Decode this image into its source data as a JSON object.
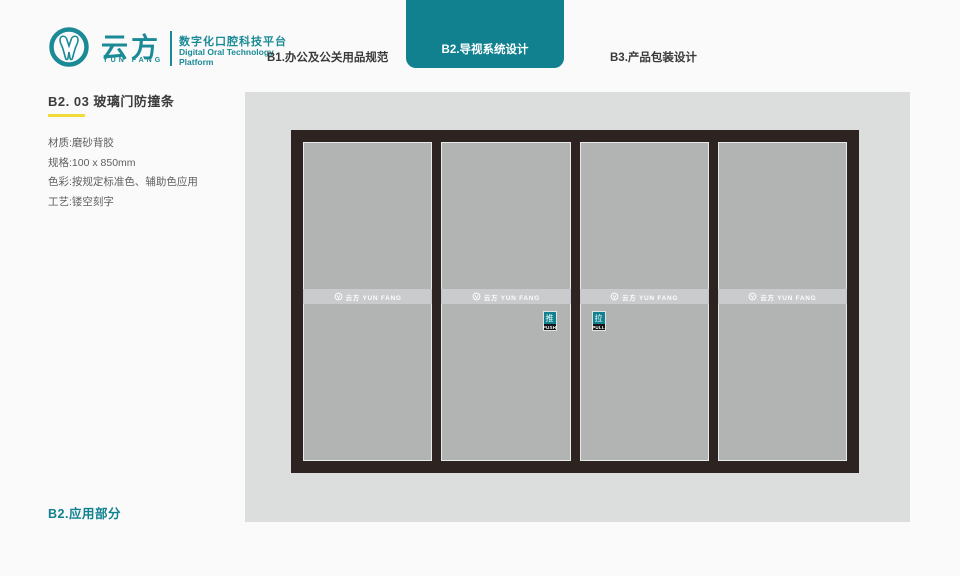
{
  "brand": {
    "name_cn": "云方",
    "name_en": "YUN FANG",
    "tagline_cn": "数字化口腔科技平台",
    "tagline_en_line1": "Digital Oral Technology",
    "tagline_en_line2": "Platform"
  },
  "nav": {
    "items": [
      {
        "label": "B1.办公及公关用品规范",
        "active": false
      },
      {
        "label": "B2.导视系统设计",
        "active": true
      },
      {
        "label": "B3.产品包装设计",
        "active": false
      }
    ]
  },
  "section": {
    "title": "B2. 03 玻璃门防撞条",
    "specs": [
      "材质:磨砂背胶",
      "规格:100 x 850mm",
      "色彩:按规定标准色、辅助色应用",
      "工艺:镂空刻字"
    ],
    "footer": "B2.应用部分"
  },
  "artboard": {
    "door_logo_text": "云方 YUN FANG",
    "push_cn": "推",
    "push_en": "PUSH",
    "pull_cn": "拉",
    "pull_en": "PULL"
  },
  "colors": {
    "brand_teal": "#1a8a96",
    "tab_teal": "#11808f",
    "accent_yellow": "#f2da3a",
    "door_frame": "#2d2422",
    "glass": "#b2b3b3",
    "frosted_strip": "#c9cbcc",
    "artboard_bg": "#dcdedd",
    "page_bg": "#fafafa"
  }
}
